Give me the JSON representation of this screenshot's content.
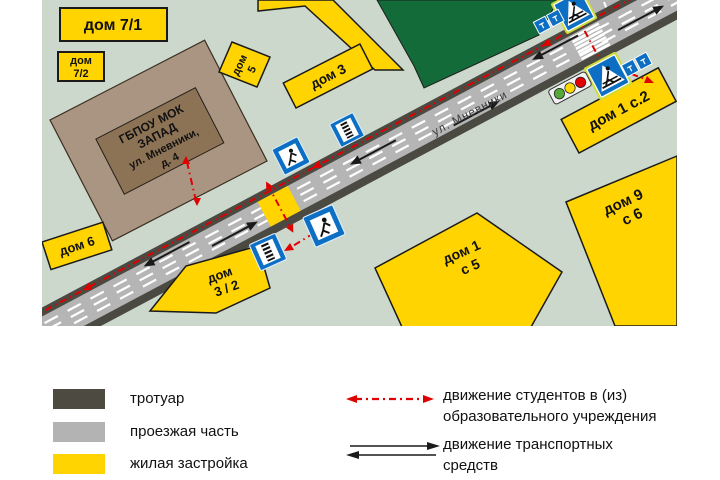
{
  "map": {
    "street": "ул. Мневники",
    "school": {
      "line1": "ГБПОУ МОК",
      "line2": "ЗАПАД",
      "line3": "ул. Мневники,",
      "line4": "д. 4"
    },
    "buildings": {
      "b71": {
        "line1": "дом 7/1"
      },
      "b72": {
        "line1": "дом",
        "line2": "7/2"
      },
      "b5": {
        "line1": "дом",
        "line2": "5"
      },
      "b3": {
        "line1": "дом 3"
      },
      "b6": {
        "line1": "дом 6"
      },
      "b32": {
        "line1": "дом",
        "line2": "3 / 2"
      },
      "b1s2": {
        "line1": "дом 1 с.2"
      },
      "b9s6": {
        "line1": "дом 9",
        "line2": "с 6"
      },
      "b1s5": {
        "line1": "дом 1",
        "line2": "с 5"
      }
    },
    "icons": {
      "pedestrian_crossing_sign": "blue square, white triangle with pedestrian on zebra",
      "crosswalk_marking_sign": "blue square with striped crosswalk bar",
      "pedestrian_route_sign": "blue square with walking figure",
      "sign_plates": "pair of small blue plates",
      "traffic_light": "horizontal green-yellow-red signal"
    }
  },
  "legend": {
    "items": [
      {
        "label": "тротуар",
        "color": "#4d4a41"
      },
      {
        "label": "проезжая часть",
        "color": "#b3b3b3"
      },
      {
        "label": "жилая застройка",
        "color": "#ffd400"
      }
    ],
    "routes": [
      {
        "line1": "движение студентов в (из)",
        "line2": "образовательного учреждения",
        "color": "#e00000"
      },
      {
        "line1": "движение транспортных",
        "line2": "средств",
        "color": "#1a1a1a"
      }
    ]
  },
  "colors": {
    "map_background": "#cdd8cc",
    "park": "#146b3a",
    "building": "#ffd400",
    "roadway": "#b5b5b5",
    "sidewalk": "#4b4a42",
    "school_building": "#a99582",
    "school_label_panel": "#8d7355",
    "student_route": "#e00000",
    "sign_blue": "#0d6fc4",
    "crossing_highlight": "#ffd400",
    "traffic_light_green": "#55a839",
    "traffic_light_yellow": "#ffd800",
    "traffic_light_red": "#e00000"
  }
}
